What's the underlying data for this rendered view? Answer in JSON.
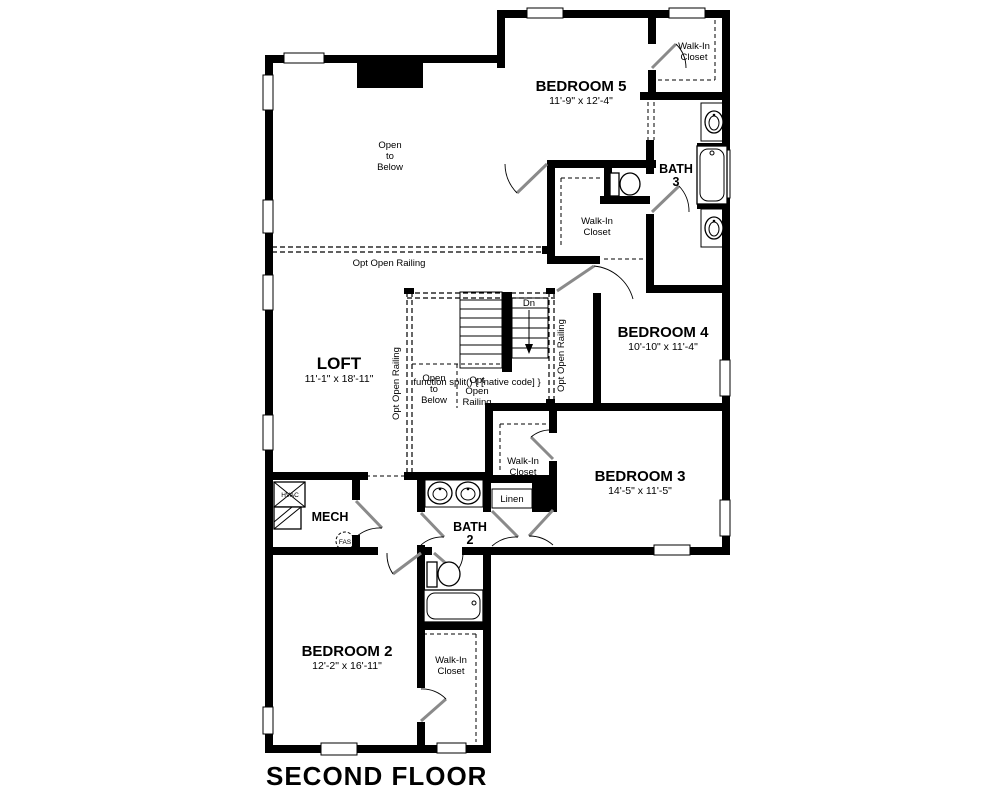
{
  "title": "SECOND FLOOR",
  "rooms": {
    "bedroom5": {
      "name": "BEDROOM 5",
      "dims": "11'-9\" x 12'-4\""
    },
    "bedroom4": {
      "name": "BEDROOM 4",
      "dims": "10'-10\" x 11'-4\""
    },
    "bedroom3": {
      "name": "BEDROOM 3",
      "dims": "14'-5\" x 11'-5\""
    },
    "bedroom2": {
      "name": "BEDROOM 2",
      "dims": "12'-2\" x 16'-11\""
    },
    "loft": {
      "name": "LOFT",
      "dims": "11'-1\" x 18'-11\""
    },
    "bath3": {
      "name": "BATH",
      "number": "3"
    },
    "bath2": {
      "name": "BATH",
      "number": "2"
    },
    "mech": {
      "name": "MECH"
    }
  },
  "labels": {
    "walk_in_closet": {
      "line1": "Walk-In",
      "line2": "Closet"
    },
    "linen": "Linen",
    "open_to_below": {
      "line1": "Open",
      "line2": "to",
      "line3": "Below"
    },
    "opt_open_railing": "Opt Open Railing",
    "dn": "Dn",
    "hvac": "HVAC",
    "fas": "FAS"
  },
  "colors": {
    "wall": "#000000",
    "background": "#ffffff",
    "door_leaf": "#8a8a8a"
  }
}
